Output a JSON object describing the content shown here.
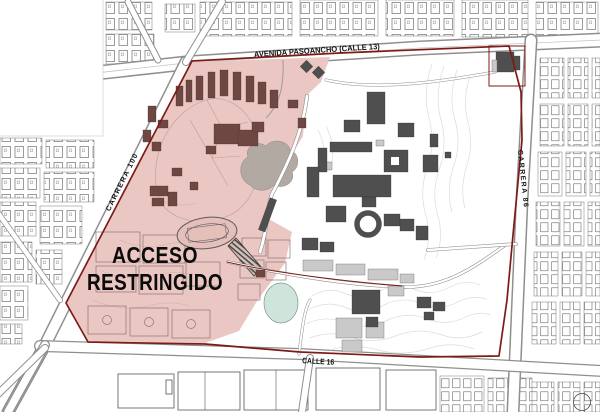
{
  "map": {
    "restricted_overlay": {
      "line1": "ACCESO",
      "line2": "RESTRINGIDO"
    },
    "street_labels": {
      "north": "AVENIDA PASOANCHO (CALLE 13)",
      "west": "CARRERA 100",
      "east": "CARRERA 86",
      "south": "CALLE 16"
    }
  },
  "colors": {
    "boundary_red": "#7d1b16",
    "restricted_fill": "#eac7c2",
    "restricted_building": "#6e4642",
    "campus_building": "#4f4f4f",
    "pond_green": "#cfe4da",
    "grove_gray": "#b2a9a3",
    "road_edge": "#8f8f8f",
    "contour_gray": "#dcdcdc",
    "contour_pink": "#d8b6b1",
    "court_outline": "#8f7672",
    "label_black": "#111111"
  }
}
